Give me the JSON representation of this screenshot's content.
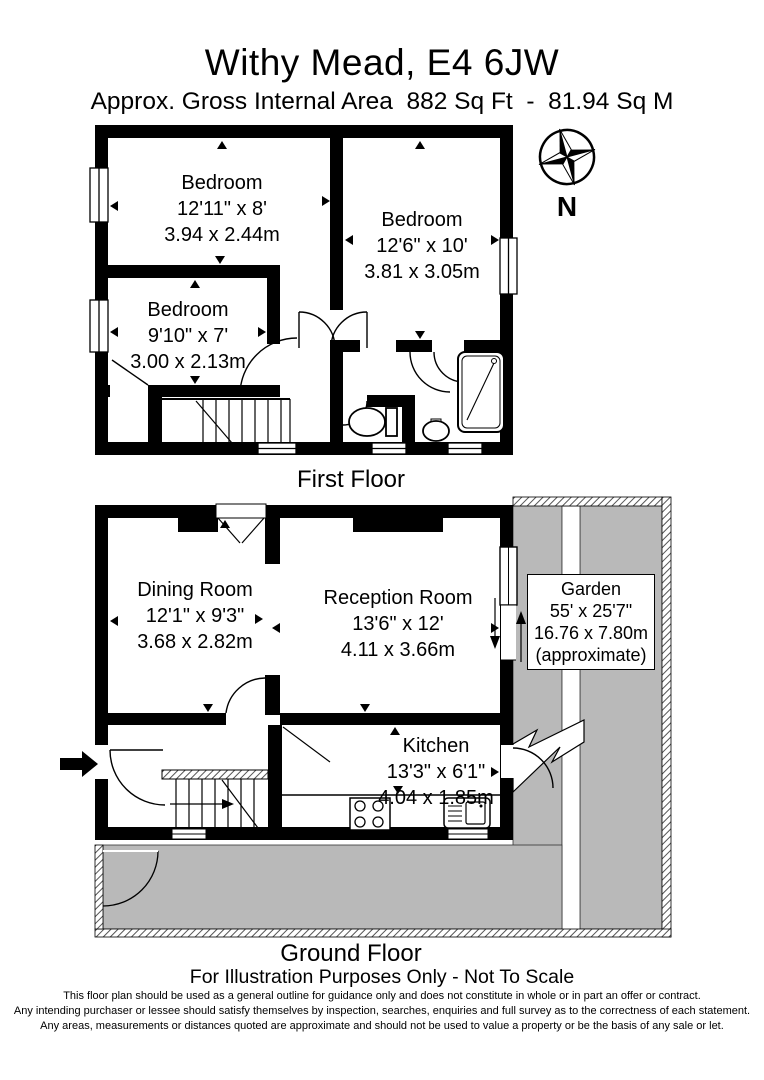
{
  "header": {
    "title": "Withy Mead, E4 6JW",
    "subtitle": "Approx. Gross Internal Area  882 Sq Ft  -  81.94 Sq M"
  },
  "compass": {
    "label": "N"
  },
  "first_floor": {
    "caption": "First Floor",
    "rooms": [
      {
        "name": "Bedroom",
        "imperial": "12'11\" x 8'",
        "metric": "3.94 x 2.44m"
      },
      {
        "name": "Bedroom",
        "imperial": "12'6\" x 10'",
        "metric": "3.81 x 3.05m"
      },
      {
        "name": "Bedroom",
        "imperial": "9'10\" x 7'",
        "metric": "3.00 x 2.13m"
      }
    ]
  },
  "ground_floor": {
    "caption": "Ground Floor",
    "rooms": [
      {
        "name": "Dining Room",
        "imperial": "12'1\" x 9'3\"",
        "metric": "3.68 x 2.82m"
      },
      {
        "name": "Reception Room",
        "imperial": "13'6\" x 12'",
        "metric": "4.11 x 3.66m"
      },
      {
        "name": "Kitchen",
        "imperial": "13'3\" x 6'1\"",
        "metric": "4.04 x 1.85m"
      }
    ],
    "garden": {
      "name": "Garden",
      "imperial": "55' x 25'7\"",
      "metric": "16.76 x 7.80m",
      "note": "(approximate)"
    }
  },
  "footnote": "For Illustration Purposes Only - Not To Scale",
  "disclaimer": {
    "line1": "This floor plan should be used as a general outline for guidance only and does not constitute in whole or in part an offer or contract.",
    "line2": "Any intending purchaser or lessee should satisfy themselves by inspection, searches, enquiries and full survey as to the correctness of each statement.",
    "line3": "Any areas, measurements or distances quoted are approximate and should not be used to value a property or be the basis of any sale or let."
  },
  "colors": {
    "wall": "#000000",
    "garden_fill": "#b9b9b9",
    "background": "#ffffff"
  }
}
